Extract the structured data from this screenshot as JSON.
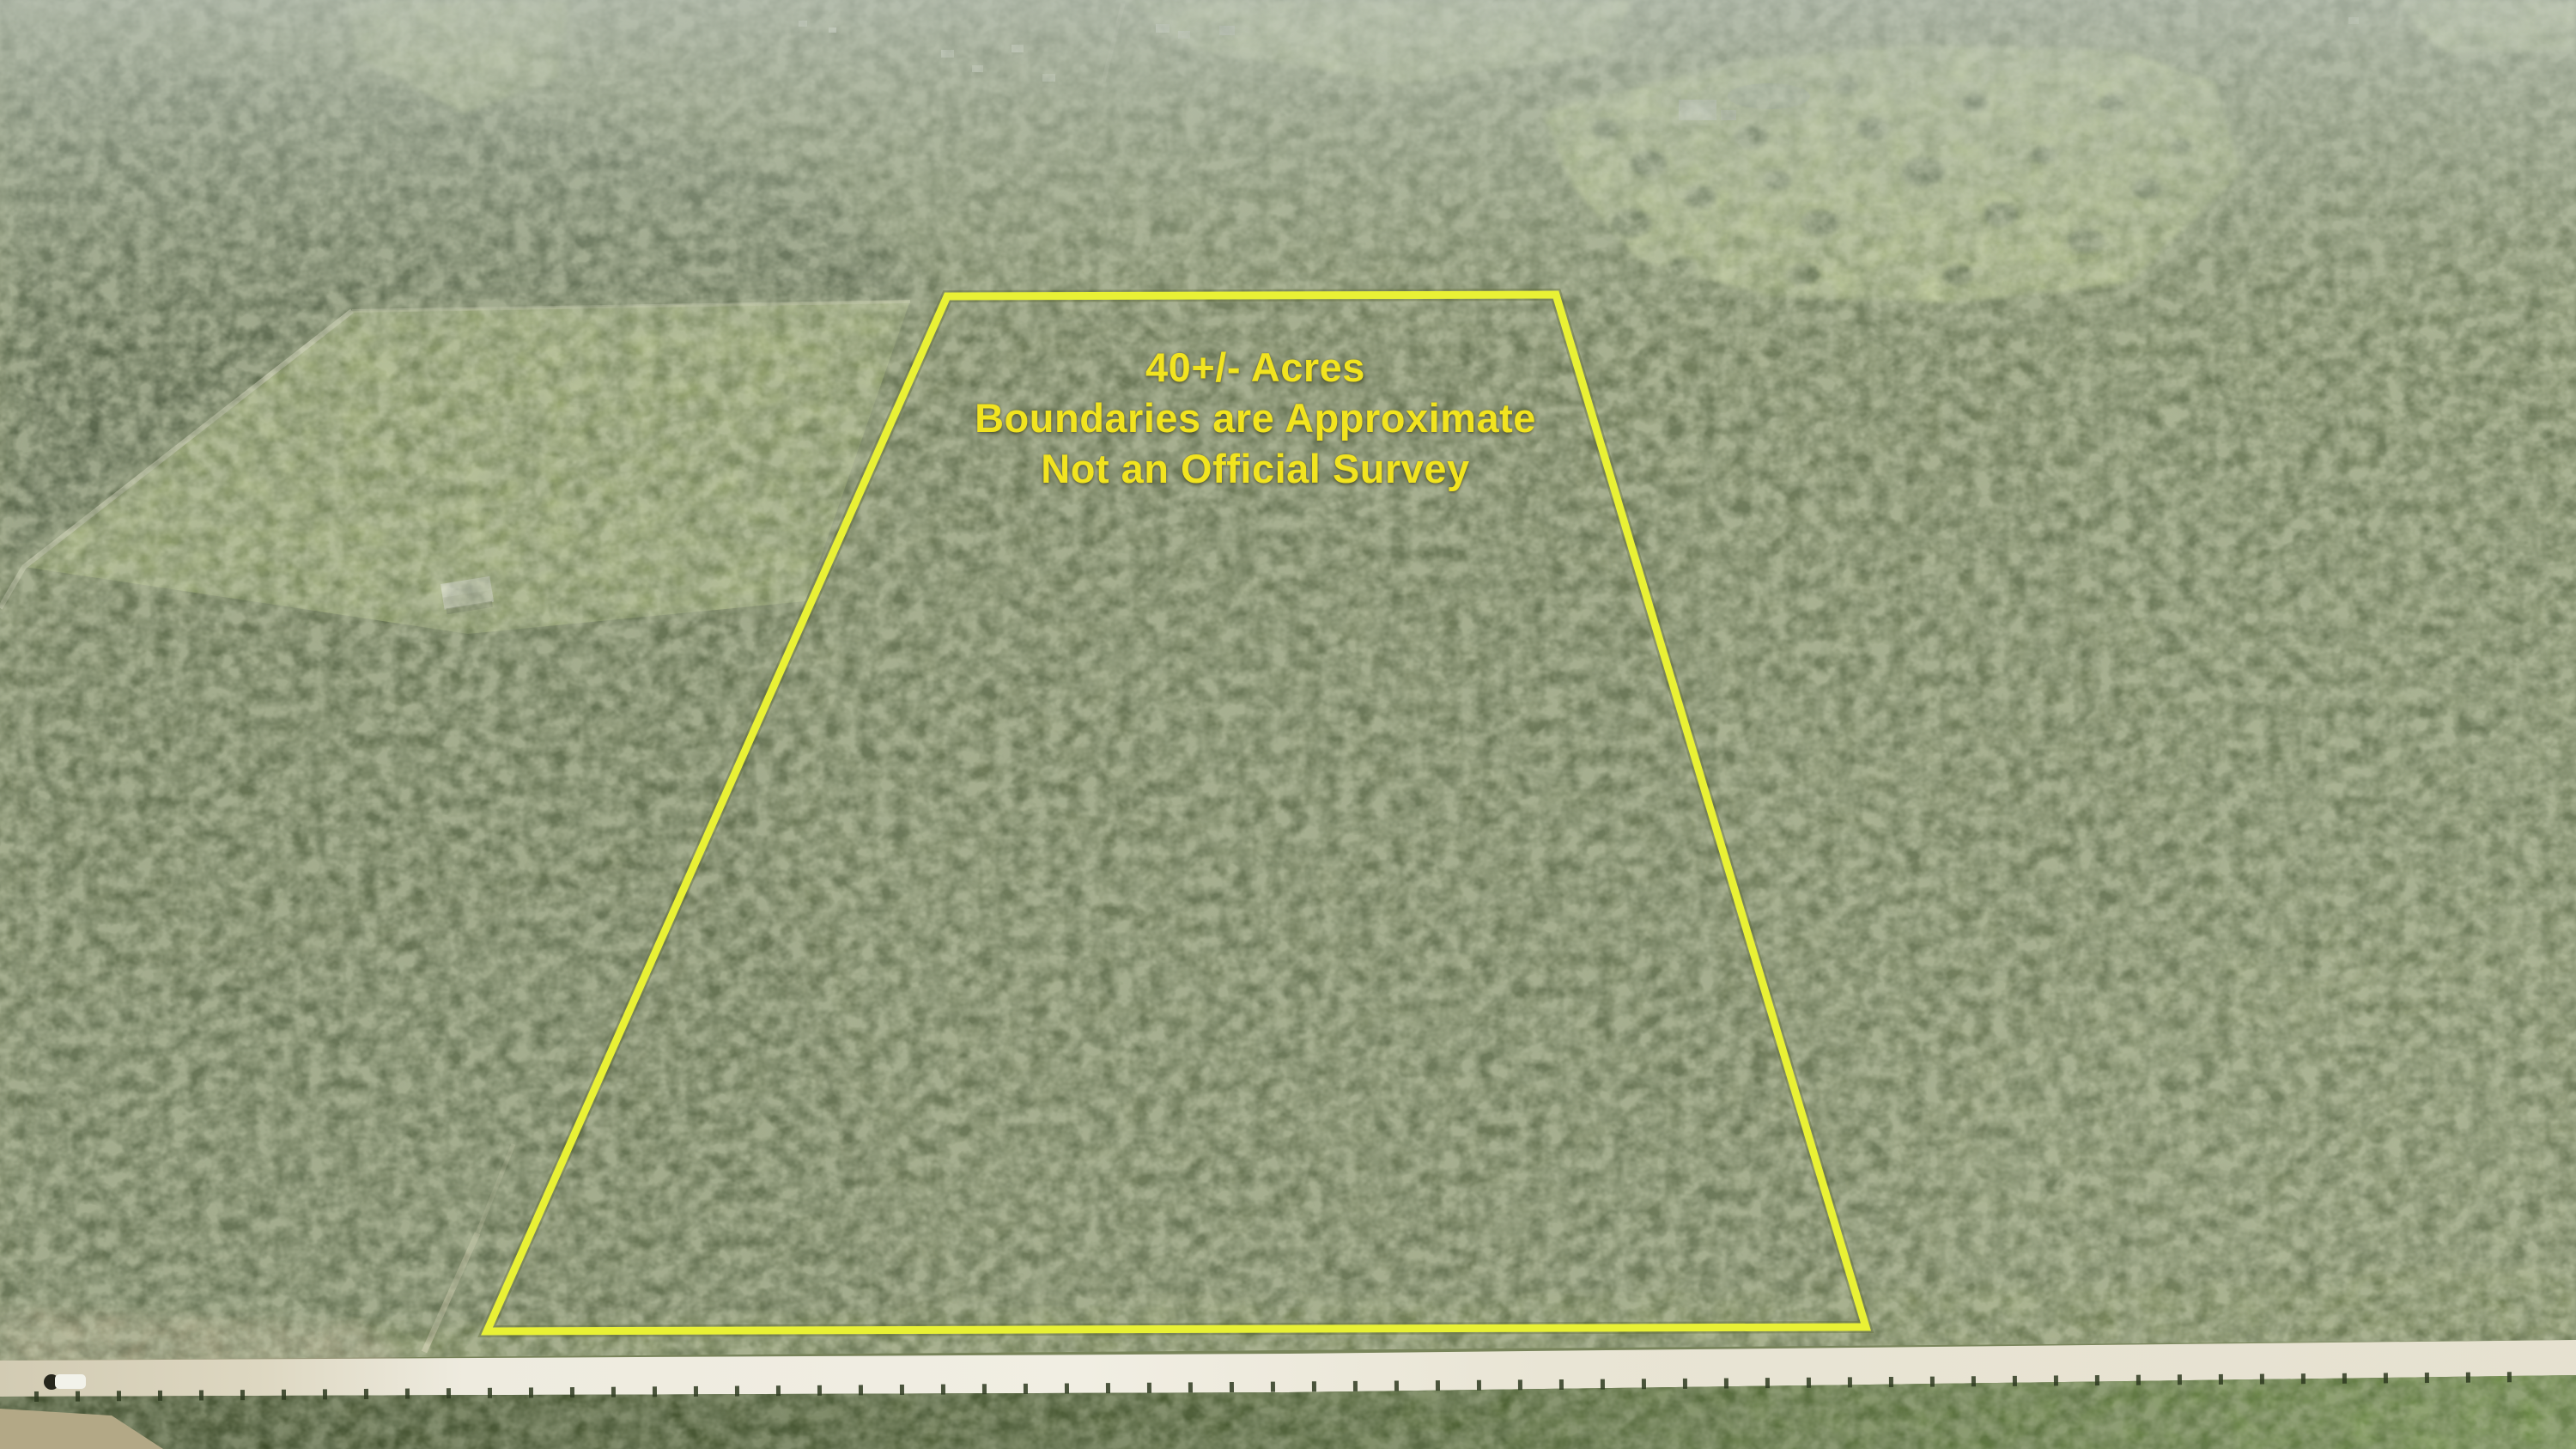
{
  "photo_overlay": {
    "acreage_line": "40+/- Acres",
    "disclaimer_line_1": "Boundaries are Approximate",
    "disclaimer_line_2": "Not an Official Survey",
    "annotation_text_color": "#f2e41f",
    "boundary_outline_color": "#e9f135"
  },
  "scene_colors": {
    "forest_base": "#77825f",
    "dark_forest": "#4d5a42",
    "cleared_field": "#9dab72",
    "pasture": "#bfcc8d",
    "dirt_road": "#efece0",
    "roadside_scrub": "#45562d",
    "haze": "#bdc5be"
  }
}
